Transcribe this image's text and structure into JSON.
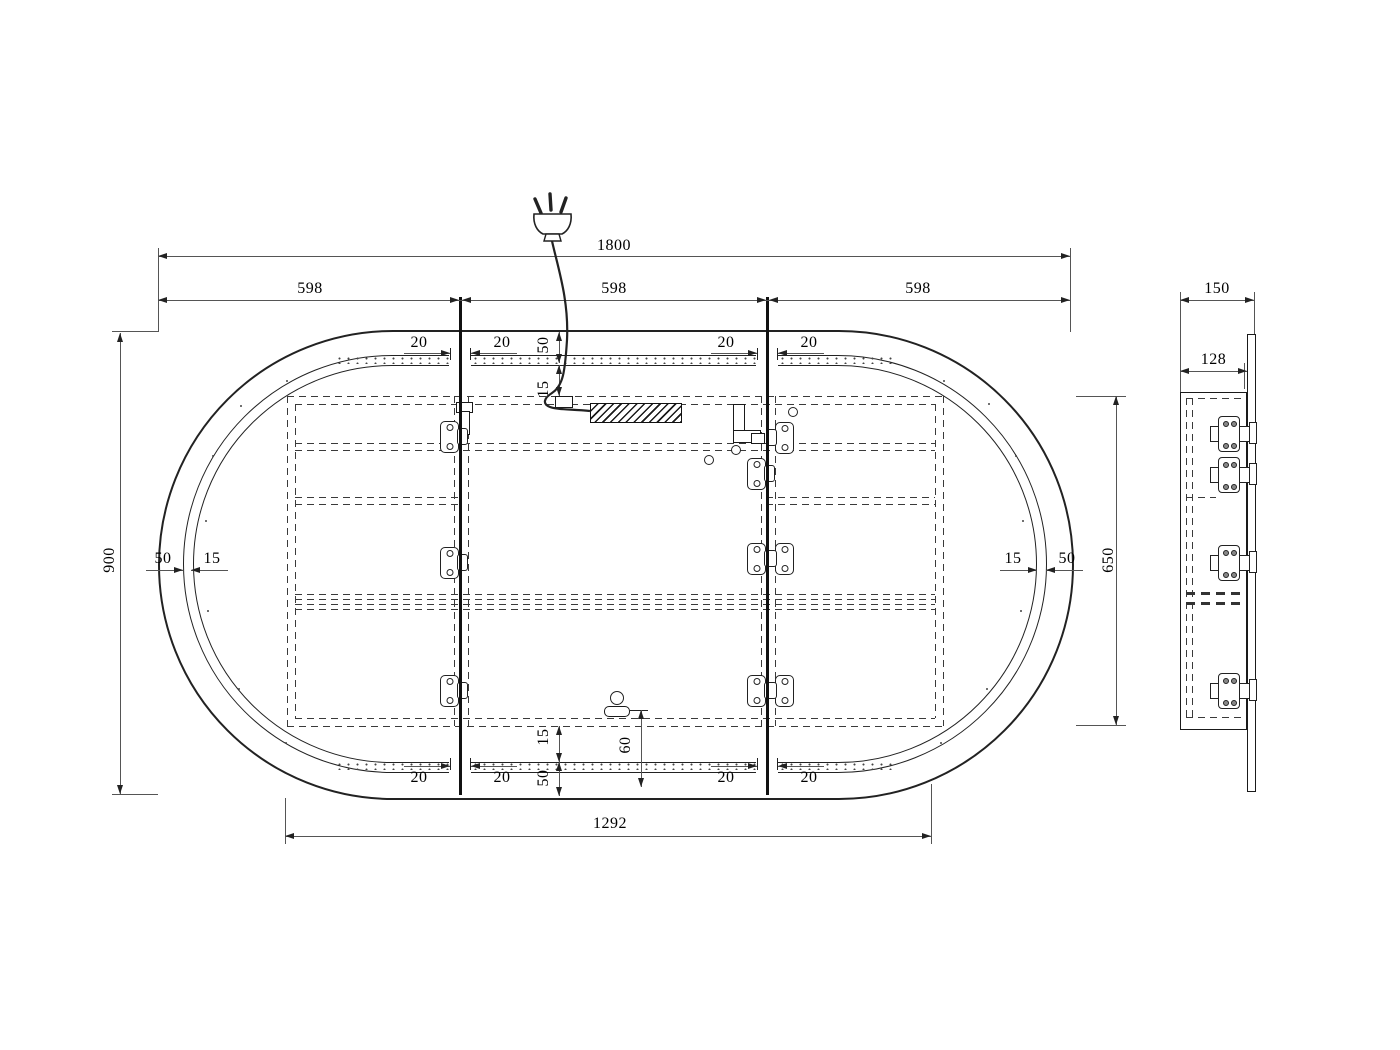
{
  "dims": {
    "overall_width": "1800",
    "segment_width": "598",
    "overall_height": "900",
    "cavity_height": "650",
    "carcass_width": "1292",
    "side_total_depth": "150",
    "side_cabinet_depth": "128",
    "frame_border": "50",
    "led_strip": "15",
    "door_gap": "20",
    "sensor_offset": "60"
  },
  "colors": {
    "line": "#1a1a1a",
    "dim_line": "#444444",
    "background": "#ffffff"
  },
  "icons": {
    "plug": "power-plug-icon",
    "cable": "power-cable",
    "driver": "led-driver-hatched-box",
    "hinge": "concealed-hinge-icon",
    "sensor": "touch-sensor-icon",
    "clamp": "cable-clamp"
  }
}
